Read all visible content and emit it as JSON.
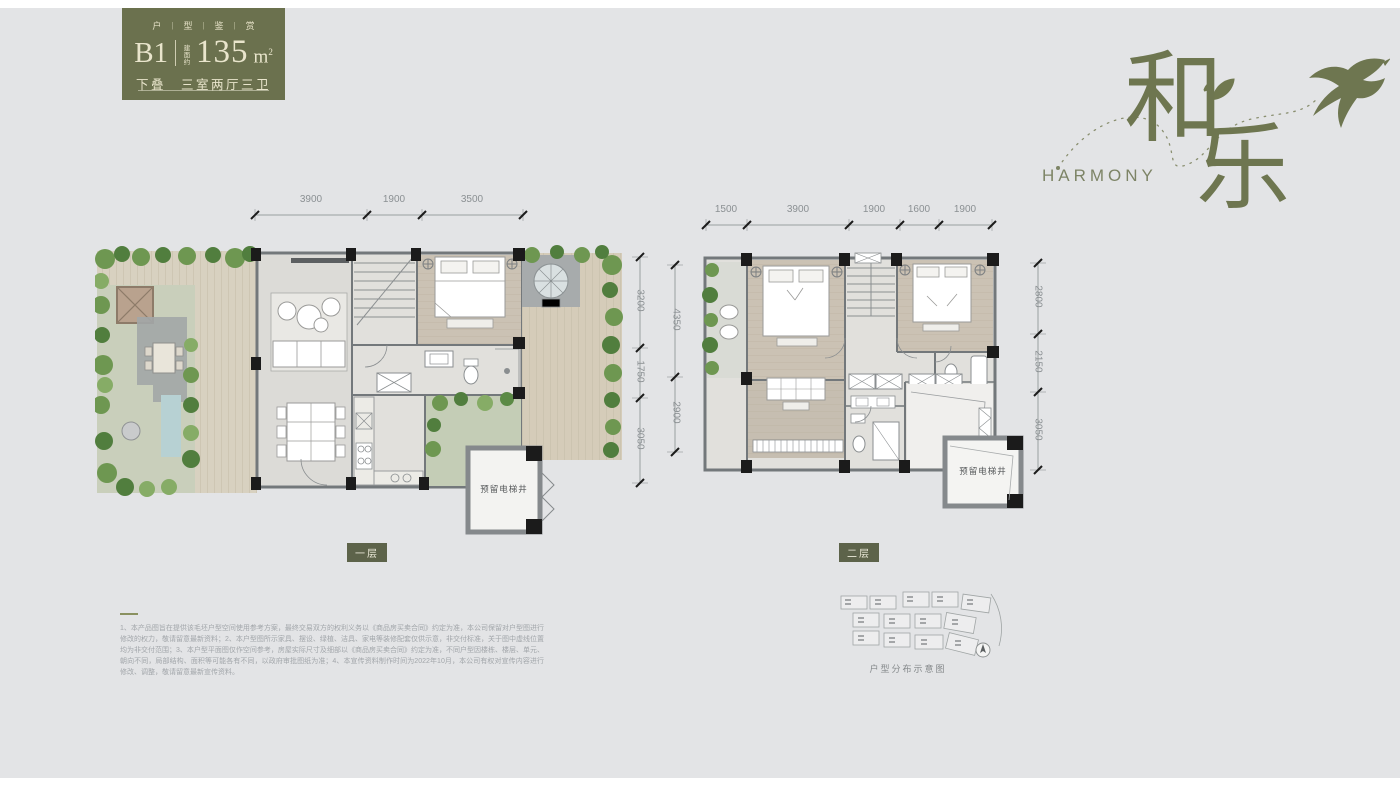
{
  "page": {
    "background": "#e3e4e6"
  },
  "badge": {
    "background": "#6b714e",
    "series": [
      "户",
      "型",
      "鉴",
      "赏"
    ],
    "separator": "|",
    "unit_code": "B1",
    "area_label": "建面约",
    "area_value": "135",
    "area_unit": "m",
    "area_sup": "2",
    "layout_line": "下叠　三室两厅三卫"
  },
  "brand": {
    "char_top": "和",
    "char_bottom": "乐",
    "english": "HARMONY",
    "color": "#6e7650"
  },
  "plans": {
    "first": {
      "label": "一层",
      "elevator": "预留电梯井",
      "dims_top": [
        "3900",
        "1900",
        "3500"
      ],
      "dims_right_inner": [
        "3200",
        "1750",
        "3050"
      ],
      "dims_right_outer": [
        "4350",
        "2900"
      ]
    },
    "second": {
      "label": "二层",
      "elevator": "预留电梯井",
      "dims_top": [
        "1500",
        "3900",
        "1900",
        "1600",
        "1900"
      ],
      "dims_right": [
        "2800",
        "2150",
        "3050"
      ]
    }
  },
  "disclaimer": {
    "text": "1、本产品图旨在提供该毛坯户型空间使用参考方案，最终交易双方的权利义务以《商品房买卖合同》约定为准，本公司保留对户型图进行修改的权力，敬请留意最新资料；2、本户型图所示家具、摆设、绿植、洁具、家电等装修配套仅供示意，非交付标准，关于图中虚线位置均为非交付范围；3、本户型平面图仅作空间参考，房屋实际尺寸及细部以《商品房买卖合同》约定为准，不同户型因楼栋、楼层、单元、朝向不同，局部结构、面积等可能各有不同，以政府审批图纸为准；4、本宣传资料制作时间为2022年10月，本公司有权对宣传内容进行修改、调整，敬请留意最新宣传资料。"
  },
  "siteplan": {
    "caption": "户型分布示意图"
  }
}
